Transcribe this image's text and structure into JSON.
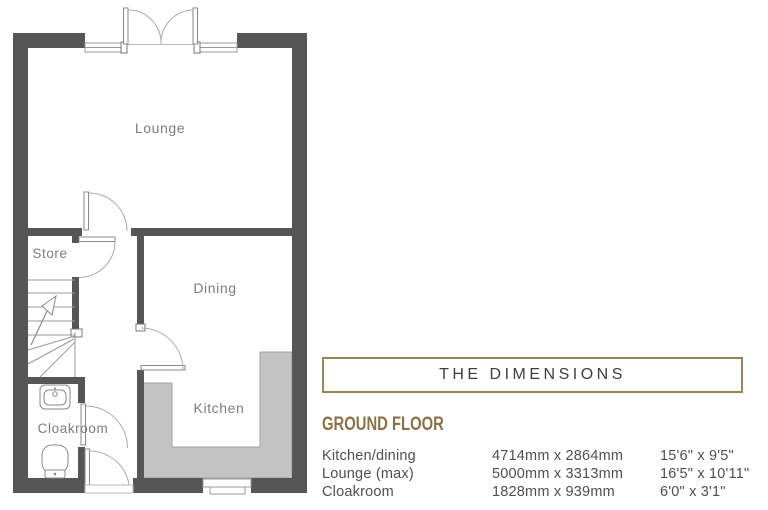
{
  "floorplan": {
    "rooms": {
      "lounge": "Lounge",
      "store": "Store",
      "dining": "Dining",
      "kitchen": "Kitchen",
      "cloakroom": "Cloakroom"
    },
    "fixture_icons": [
      "stairs-icon",
      "stairs-up-arrow-icon",
      "sink-icon",
      "toilet-icon",
      "kitchen-counter",
      "french-doors-icon",
      "window-icon",
      "door-swing-icon"
    ],
    "colors": {
      "wall": "#565656",
      "counter": "#c3c3c3",
      "line": "#9a9a9a",
      "label": "#7d7d7d"
    }
  },
  "dimensions_panel": {
    "title": "THE DIMENSIONS",
    "section": "GROUND FLOOR",
    "accent_color": "#9c8455",
    "rows": [
      {
        "room": "Kitchen/dining",
        "metric": "4714mm x 2864mm",
        "imperial": "15'6\" x 9'5\""
      },
      {
        "room": "Lounge (max)",
        "metric": "5000mm x 3313mm",
        "imperial": "16'5\" x 10'11\""
      },
      {
        "room": "Cloakroom",
        "metric": "1828mm x 939mm",
        "imperial": "6'0\" x 3'1\""
      }
    ]
  }
}
